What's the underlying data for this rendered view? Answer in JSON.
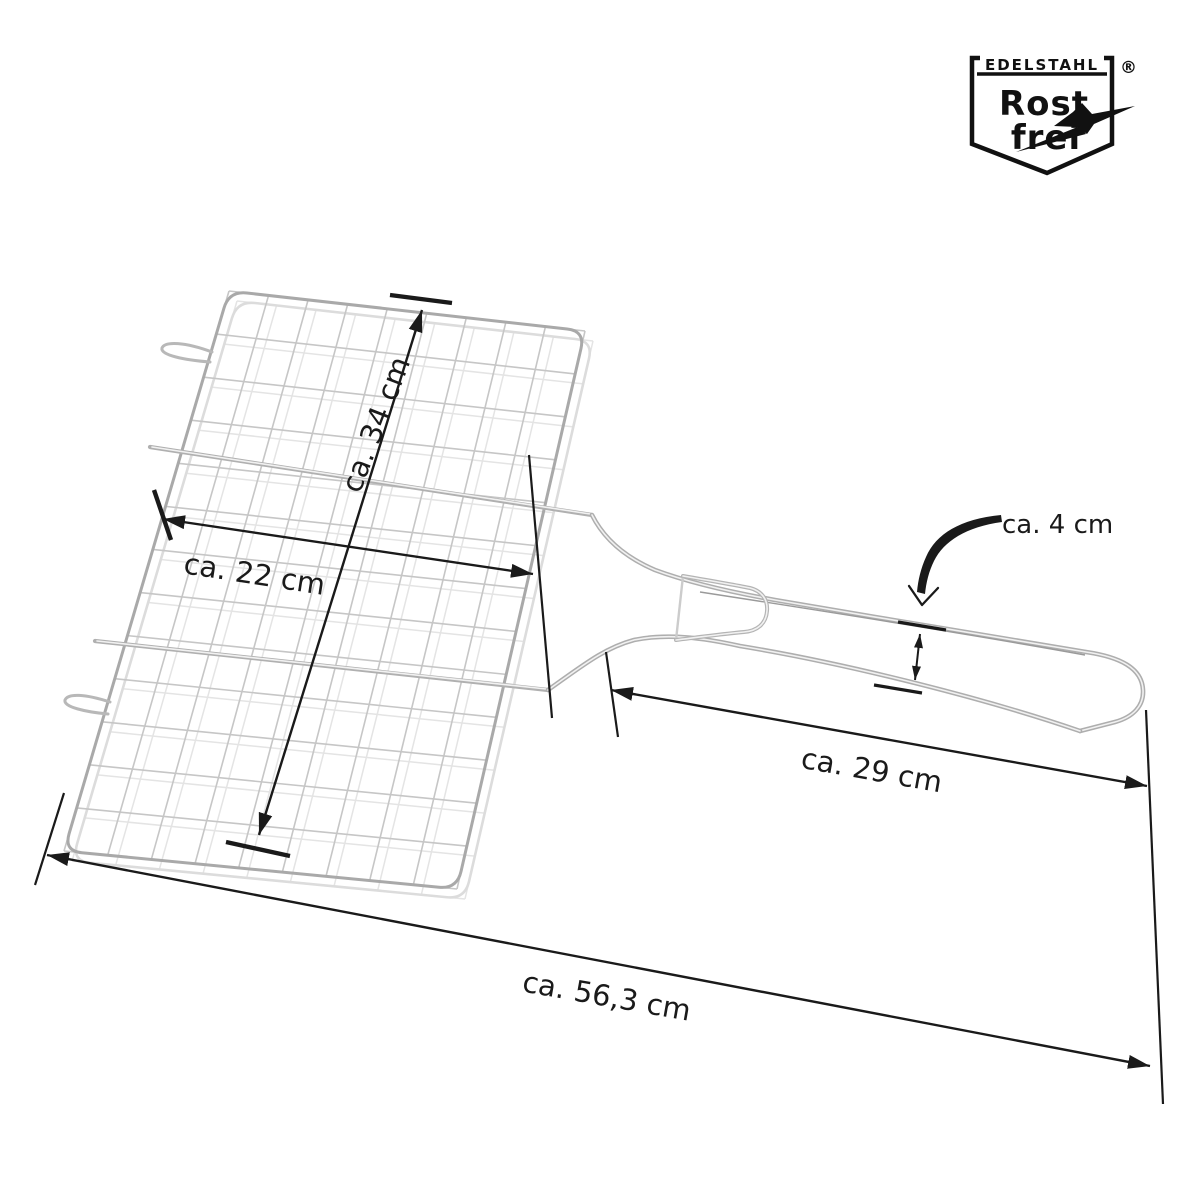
{
  "logo": {
    "header": "EDELSTAHL",
    "registered": "®",
    "line1": "Rost",
    "line2": "frei"
  },
  "dimensions": {
    "grid_length": "ca. 34 cm",
    "grid_width": "ca. 22 cm",
    "handle_gap": "ca. 4 cm",
    "handle_length": "ca. 29 cm",
    "total_length": "ca. 56,3 cm"
  },
  "colors": {
    "dimension": "#1a1a1a",
    "wire": "#c6c6c6",
    "logo": "#111111",
    "background": "#ffffff"
  }
}
